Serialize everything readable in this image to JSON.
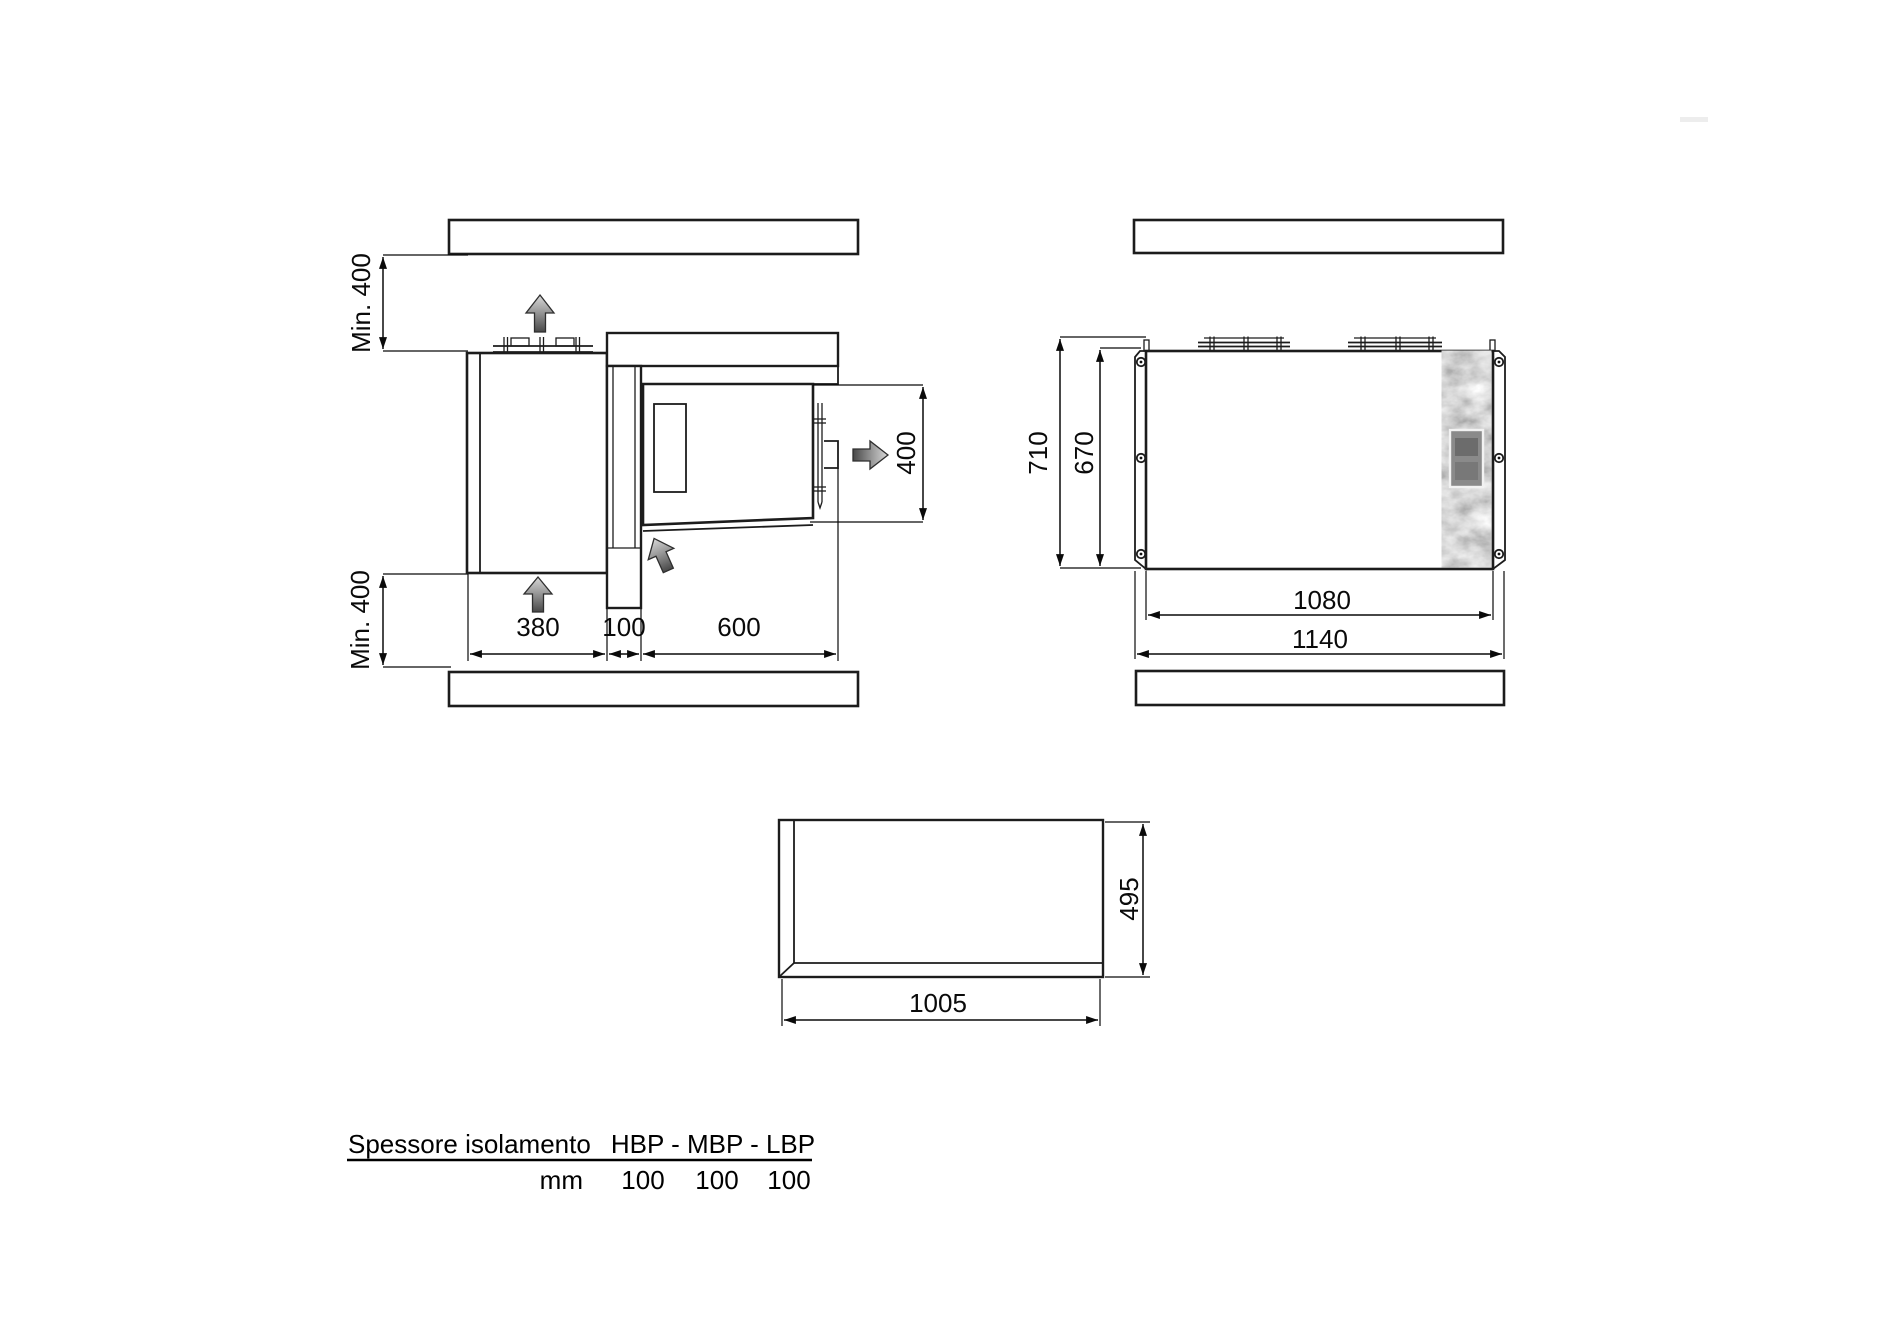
{
  "colors": {
    "wall_fill": "#b3b3b3",
    "unit_fill": "#eaeaea",
    "panel_fill": "#f0f0f0",
    "bar_fill": "#f4f4f4",
    "window_fill": "#d8d8d8",
    "band_fill": "#f8f8f8",
    "outline": "#1c1c1c",
    "dim_color": "#0a0a0a"
  },
  "top_view": {
    "clearance_top_label": "Min. 400",
    "clearance_bottom_label": "Min. 400",
    "condenser_depth_label": "380",
    "wall_thickness_label": "100",
    "room_depth_label": "600",
    "unit_width_label": "400"
  },
  "front_view": {
    "overall_height_label": "710",
    "body_height_label": "670",
    "body_width_label": "1080",
    "overall_width_label": "1140"
  },
  "cutout_view": {
    "width_label": "1005",
    "height_label": "495"
  },
  "table": {
    "row_header": "Spessore isolamento",
    "col_header": "HBP - MBP - LBP",
    "unit_label": "mm",
    "values": [
      "100",
      "100",
      "100"
    ]
  }
}
